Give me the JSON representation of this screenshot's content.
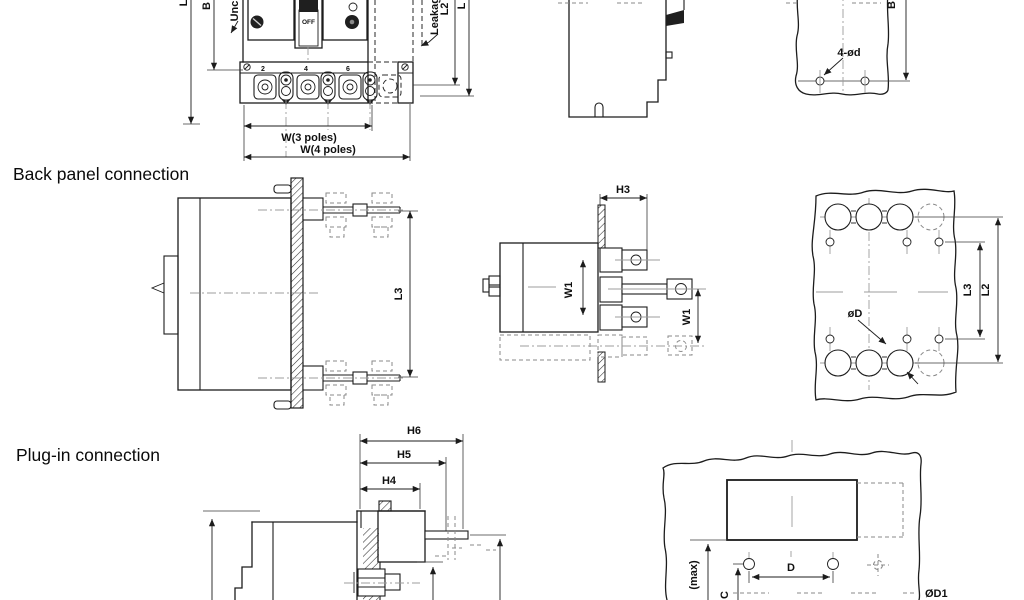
{
  "colors": {
    "background": "#ffffff",
    "line": "#1c1c1c",
    "centerline": "#9c9c9c"
  },
  "sections": {
    "top": {
      "front_view": {
        "switch_label": "OFF",
        "terminal_numbers": [
          "2",
          "4",
          "6"
        ],
        "callout_unc": "Unc",
        "callout_leakage": "Leakag",
        "dims": {
          "left_outer": "L1",
          "left_inner": "B",
          "right_inner": "L2",
          "right_outer": "L",
          "width_3_poles": "W(3 poles)",
          "width_4_poles": "W(4 poles)"
        }
      },
      "mounting_panel": {
        "holes_label": "4-ød",
        "dim_height": "B"
      }
    },
    "back_panel": {
      "heading": "Back panel connection",
      "side_view": {
        "dim_length": "L3"
      },
      "top_view": {
        "dim_depth": "H3",
        "dim_pitch_inner": "W1",
        "dim_pitch_outer": "W1"
      },
      "panel_view": {
        "hole_dia_label": "øD",
        "dim_inner": "L3",
        "dim_outer": "L2"
      }
    },
    "plug_in": {
      "heading": "Plug-in connection",
      "side_view": {
        "dim_h6": "H6",
        "dim_h5": "H5",
        "dim_h4": "H4"
      },
      "panel_view": {
        "dim_max": "(max)",
        "dim_c": "C",
        "dim_d": "D",
        "dim_d1": "ØD1"
      }
    }
  }
}
